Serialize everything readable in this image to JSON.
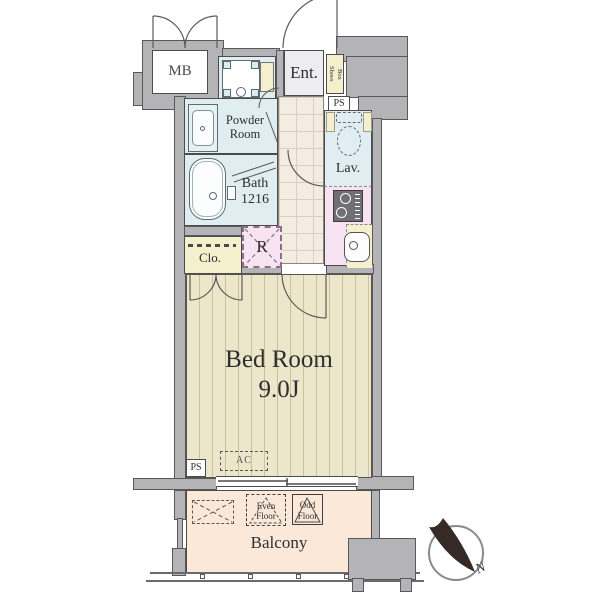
{
  "floorplan": {
    "rooms": {
      "mb": "MB",
      "entrance": "Ent.",
      "shoes_line1": "Shoes",
      "shoes_line2": "Box",
      "ps_upper": "PS",
      "powder_line1": "Powder",
      "powder_line2": "Room",
      "lavatory": "Lav.",
      "bath_line1": "Bath",
      "bath_line2": "1216",
      "closet": "Clo.",
      "fridge": "R",
      "bedroom_name": "Bed Room",
      "bedroom_size": "9.0J",
      "ps_lower": "PS",
      "ac": "AC",
      "balcony": "Balcony",
      "even_line1": "Even",
      "even_line2": "Floor",
      "odd_line1": "Odd",
      "odd_line2": "Floor"
    },
    "compass": {
      "north": "N"
    },
    "colors": {
      "wall_fill": "#b4b4b6",
      "wall_line": "#59595b",
      "wet_area_blue": "#e0eef1",
      "storage_beige": "#f4f0ce",
      "kitchen_pink": "#f7e3f1",
      "hall_tile": "#f3ece0",
      "bedroom_floor": "#ece6ca",
      "balcony_floor": "#fbe8d8",
      "entrance_floor": "#ededef"
    }
  }
}
